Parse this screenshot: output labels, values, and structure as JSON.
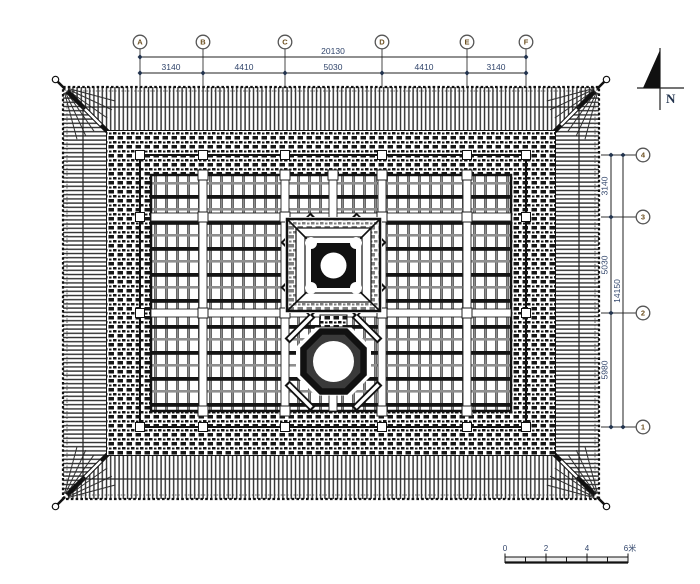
{
  "axes_top": {
    "bubbles": [
      "A",
      "B",
      "C",
      "D",
      "E",
      "F"
    ],
    "total": "20130",
    "segments": [
      "3140",
      "4410",
      "5030",
      "4410",
      "3140"
    ]
  },
  "axes_right": {
    "bubbles": [
      "4",
      "3",
      "2",
      "1"
    ],
    "total": "14150",
    "segments": [
      "3140",
      "5030",
      "5980"
    ]
  },
  "north_label": "N",
  "scale_bar": {
    "tick_labels": [
      "0",
      "2",
      "4",
      "6米"
    ]
  },
  "colors": {
    "line": "#1a1a1a",
    "dim_text": "#31456b",
    "bubble_text": "#6b4e1e",
    "fill_black": "#111111",
    "paper": "#ffffff"
  }
}
